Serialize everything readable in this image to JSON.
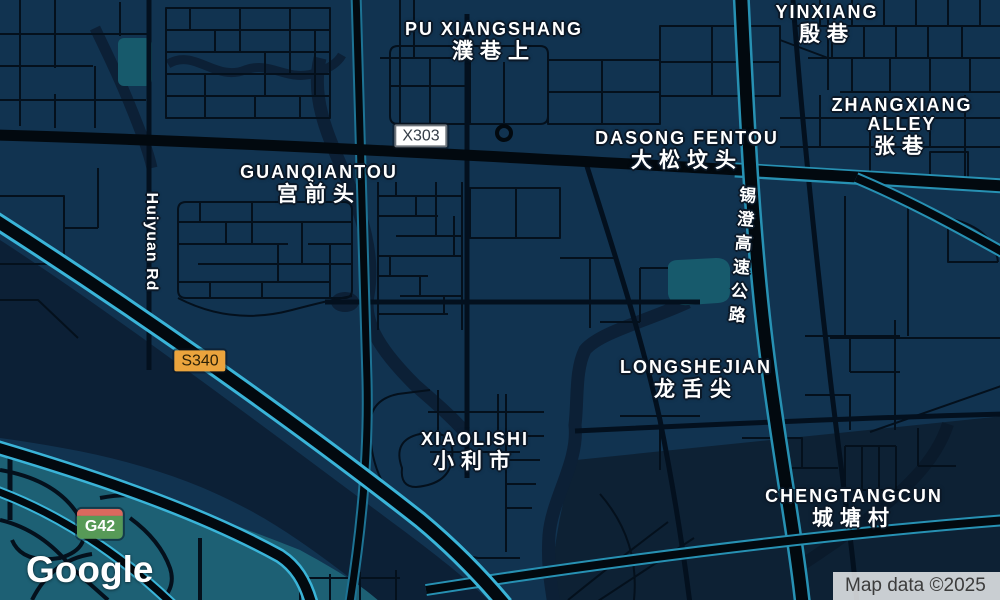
{
  "colors": {
    "land": "#113350",
    "water": "#0c2036",
    "water_dark": "#0d2134",
    "teal_zone": "#1d6074",
    "teal_patch": "#175a6c",
    "road": "#02090f",
    "road_minor": "#04101c",
    "highway_edge_bright": "#3ab4d8",
    "highway_edge": "#2791b3",
    "highway_edge_dim": "#1d7394",
    "label_text": "#ffffff",
    "label_halo": "#0b1827",
    "badge_x303_bg": "#ffffff",
    "badge_s340_bg": "#eba43d",
    "badge_g42_green": "#579a57",
    "badge_g42_red": "#d9695e"
  },
  "places": [
    {
      "id": "pu-xiangshang",
      "en": "PU XIANGSHANG",
      "zh": "濮巷上"
    },
    {
      "id": "yinxiang",
      "en": "YINXIANG",
      "zh": "殷巷"
    },
    {
      "id": "zhangxiang-alley",
      "en": "ZHANGXIANG ALLEY",
      "zh": "张巷"
    },
    {
      "id": "dasong-fentou",
      "en": "DASONG FENTOU",
      "zh": "大松坟头"
    },
    {
      "id": "guanqiantou",
      "en": "GUANQIANTOU",
      "zh": "宫前头"
    },
    {
      "id": "longshejian",
      "en": "LONGSHEJIAN",
      "zh": "龙舌尖"
    },
    {
      "id": "xiaolishi",
      "en": "XIAOLISHI",
      "zh": "小利市"
    },
    {
      "id": "chengtangcun",
      "en": "CHENGTANGCUN",
      "zh": "城塘村"
    }
  ],
  "road_labels": [
    {
      "id": "huiyuan-rd",
      "text": "Huiyuan Rd"
    },
    {
      "id": "xicheng-expressway",
      "text": "锡澄高速公路"
    }
  ],
  "badges": [
    {
      "id": "x303",
      "label": "X303"
    },
    {
      "id": "s340",
      "label": "S340"
    },
    {
      "id": "g42",
      "label": "G42"
    }
  ],
  "branding": {
    "logo_text": "Google"
  },
  "attribution": {
    "text": "Map data ©2025"
  }
}
